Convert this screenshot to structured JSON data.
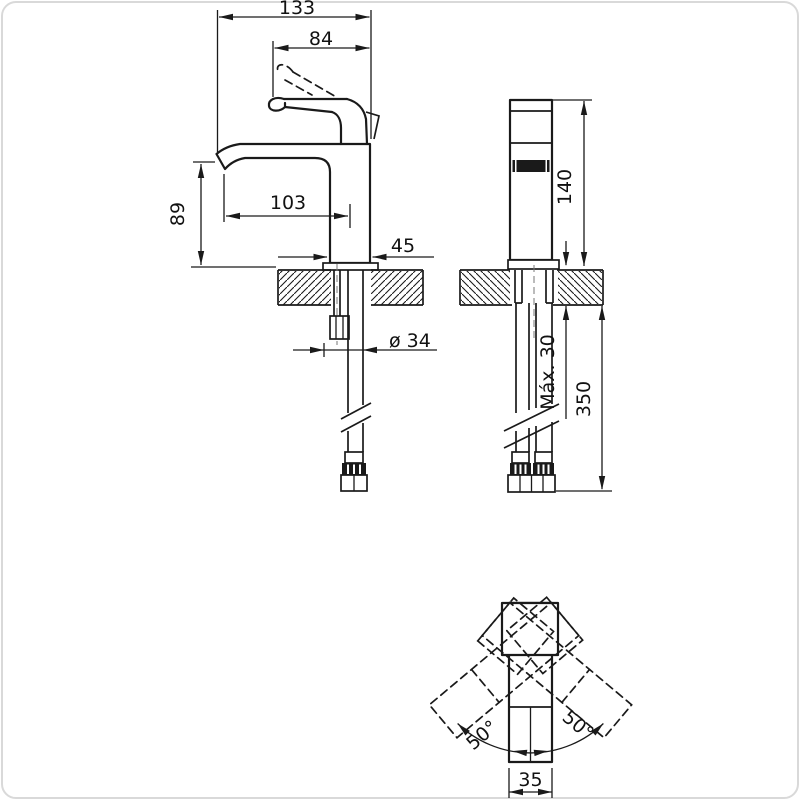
{
  "views": {
    "front": {
      "dim_total_projection": "133",
      "dim_spout_projection": "84",
      "dim_spout_reach": "103",
      "dim_spout_height": "89",
      "dim_base_width": "45",
      "dim_hole_diameter": "ø 34"
    },
    "side": {
      "dim_body_height": "140",
      "dim_max_deck_thickness": "Máx. 30",
      "dim_hose_length": "350"
    },
    "plan": {
      "dim_swing_left": "50°",
      "dim_swing_right": "50°",
      "dim_body_width": "35"
    }
  },
  "colors": {
    "line": "#1a1a1a",
    "background": "#ffffff",
    "border": "#d9d9d9"
  }
}
